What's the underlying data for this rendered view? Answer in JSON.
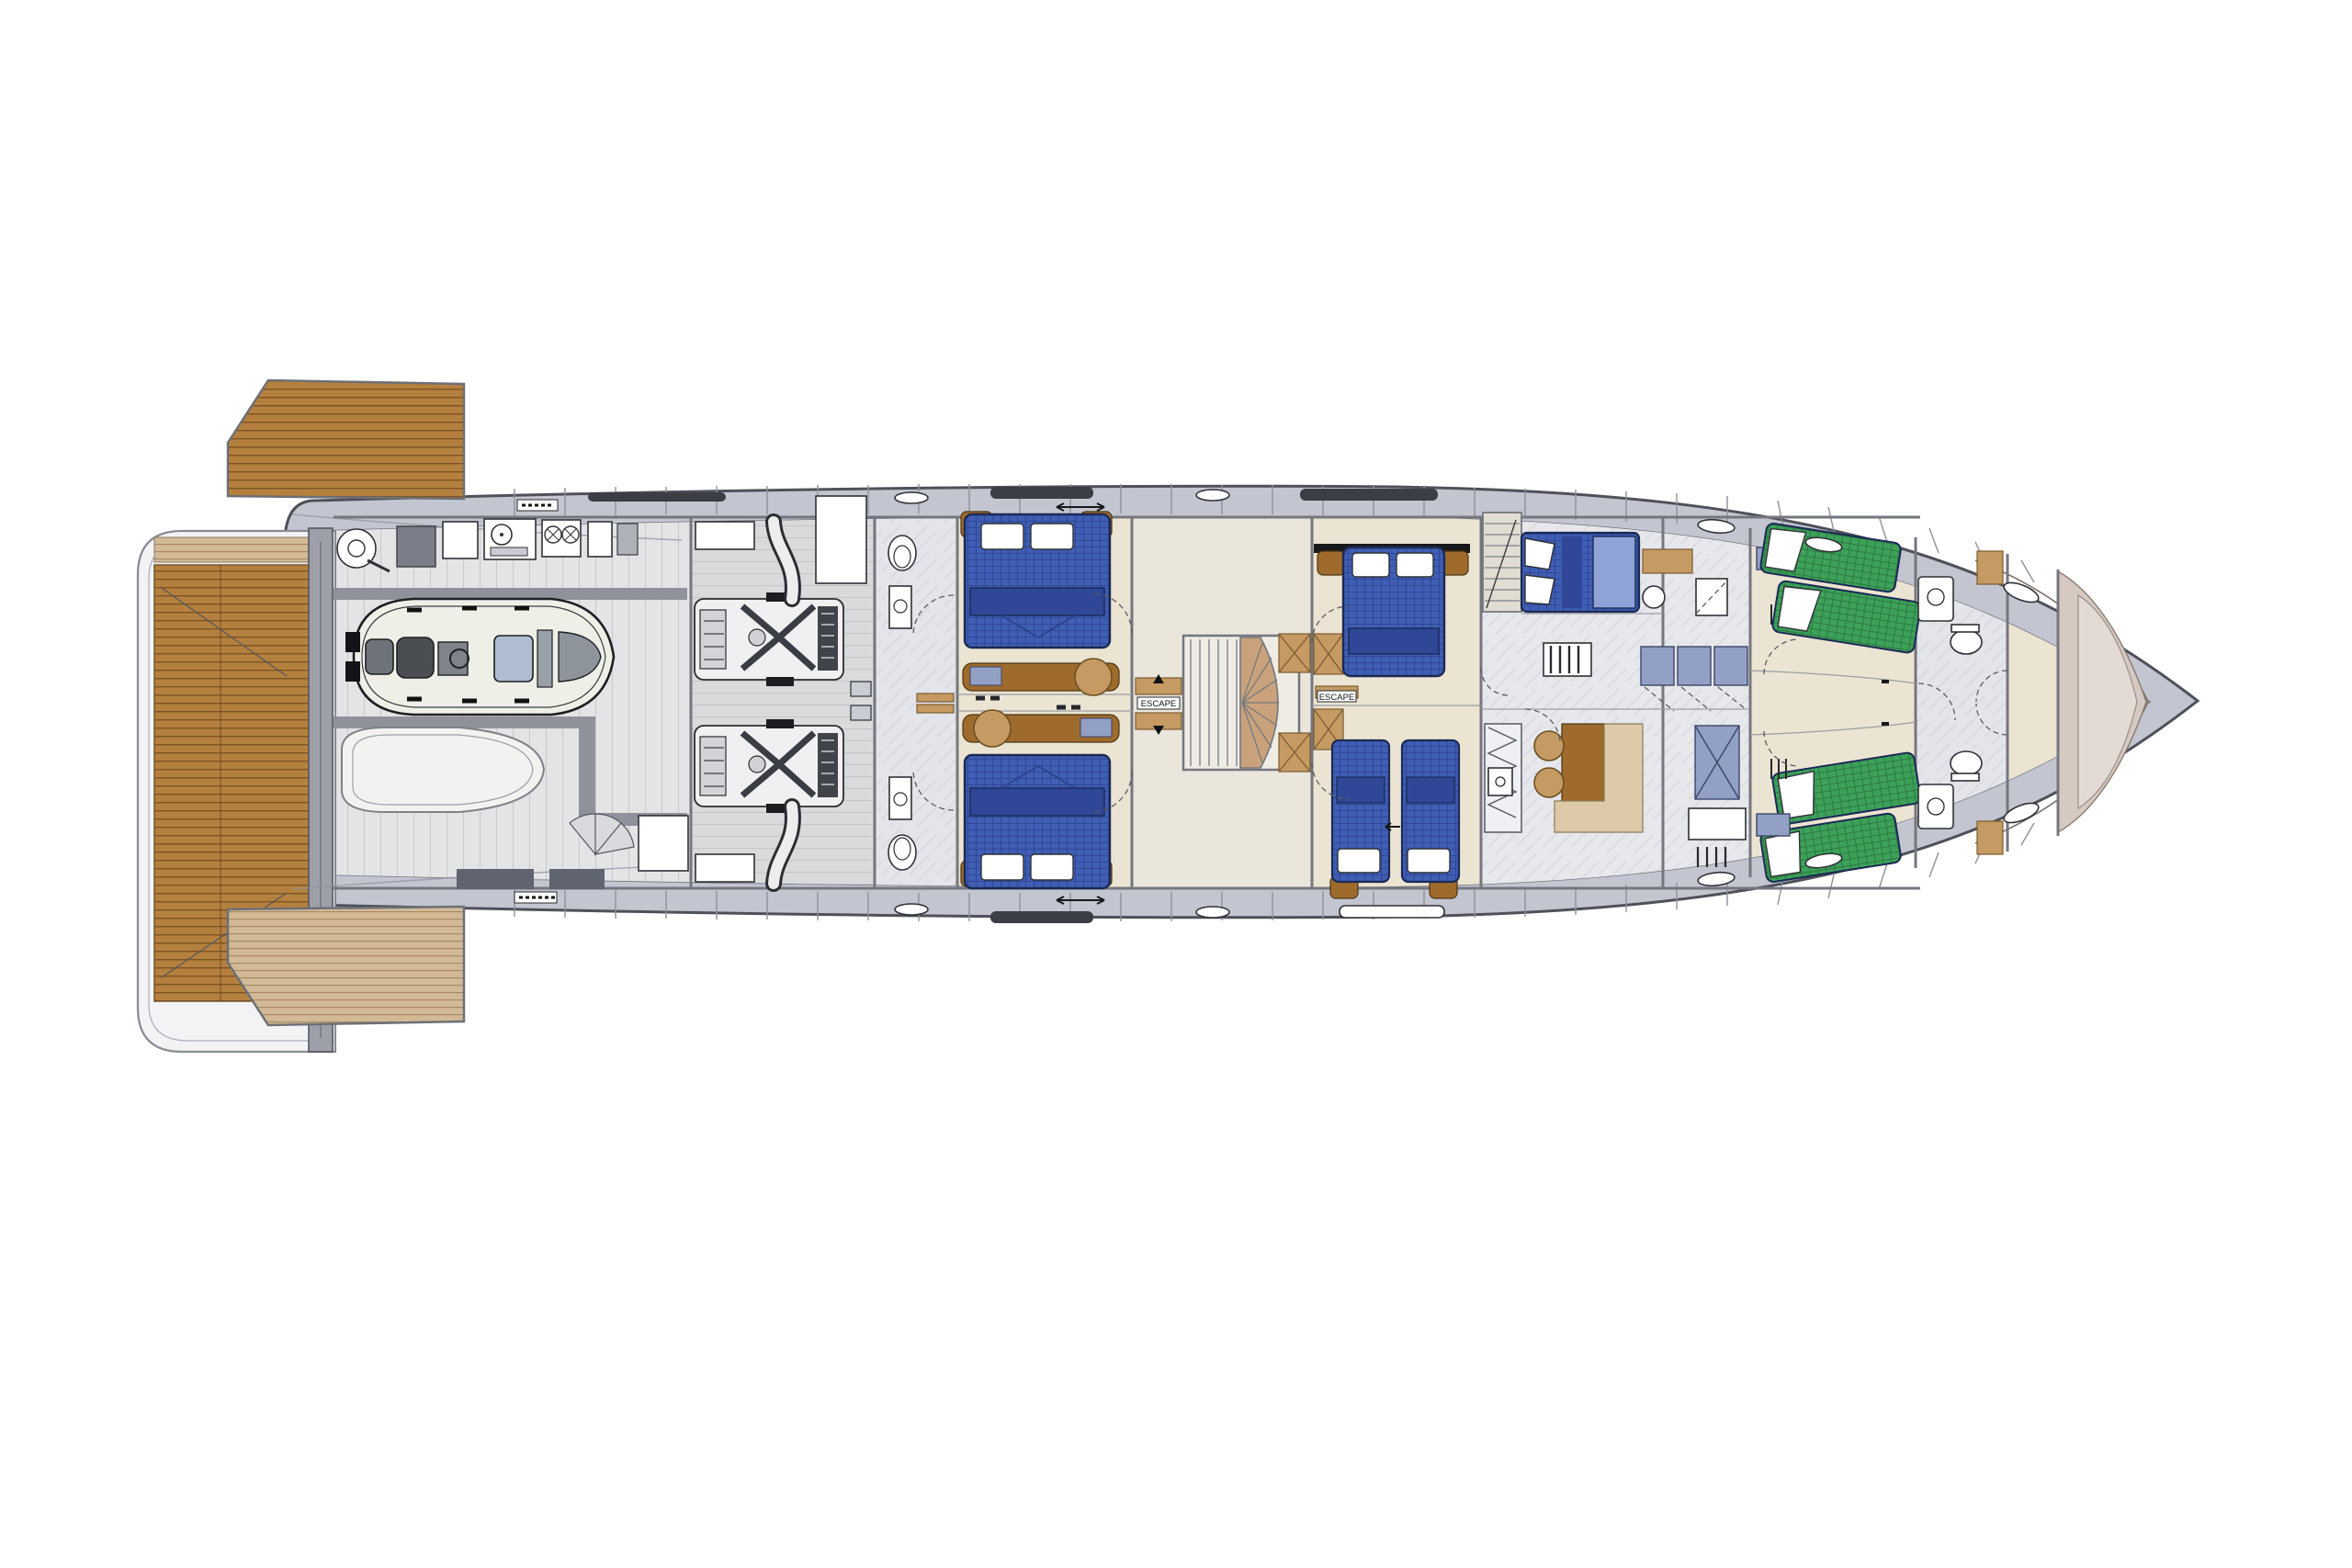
{
  "labels": {
    "escape": "ESCAPE"
  },
  "colors": {
    "background": "#ffffff",
    "hull_outline": "#4e5158",
    "hull_band": "#c3c6d0",
    "hull_inner": "#dadbdf",
    "bow_liner": "#d6c9c2",
    "bow_liner_inner": "#e4dad4",
    "platform": "#f3f3f5",
    "teak": "#b5803e",
    "teak_stripe": "#7c5424",
    "teak_pale": "#d3ba97",
    "teak_pale_stripe": "#a58a64",
    "transom": "#9da0a8",
    "garage_floor": "#e3e4e6",
    "garage_wall": "#8f929b",
    "engine_floor": "#d8dadc",
    "machinery": "#f0f0f2",
    "machinery_dark": "#40434a",
    "marble": "#e4e5ea",
    "marble_line": "#c9cbd6",
    "cabin_floor": "#ece4d2",
    "crew_floor": "#e7e8ec",
    "bed_blue": "#3f5eb4",
    "bed_blue_dark": "#2f4796",
    "bed_outline": "#1c2a55",
    "bunk_green": "#3da15a",
    "bunk_green_dark": "#2b7a41",
    "pillow": "#ffffff",
    "wood": "#9e6b2d",
    "wood_light": "#c59a63",
    "stone": "#dccaa9",
    "locker_blue": "#93a0c6",
    "window_dark": "#3b3e45",
    "wall": "#74777e",
    "fixture_white": "#ffffff",
    "tender_hull": "#eef0e8",
    "tender_seat": "#4a4d52",
    "tender_trim": "#9aa0a8"
  }
}
